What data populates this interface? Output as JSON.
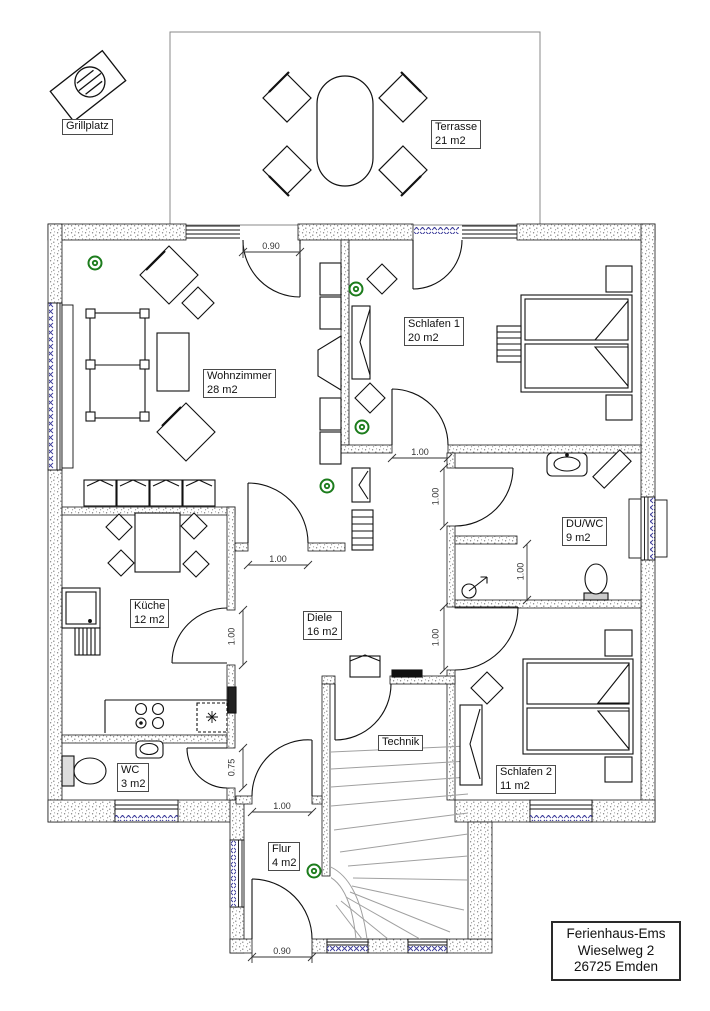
{
  "title_block": {
    "lines": [
      "Ferienhaus-Ems",
      "Wieselweg 2",
      "26725 Emden"
    ]
  },
  "rooms": {
    "grillplatz": {
      "name": "Grillplatz",
      "area": ""
    },
    "terrasse": {
      "name": "Terrasse",
      "area": "21 m2"
    },
    "wohnzimmer": {
      "name": "Wohnzimmer",
      "area": "28 m2"
    },
    "schlafen1": {
      "name": "Schlafen 1",
      "area": "20 m2"
    },
    "duwc": {
      "name": "DU/WC",
      "area": "9 m2"
    },
    "kueche": {
      "name": "Küche",
      "area": "12 m2"
    },
    "diele": {
      "name": "Diele",
      "area": "16 m2"
    },
    "technik": {
      "name": "Technik",
      "area": ""
    },
    "wc": {
      "name": "WC",
      "area": "3 m2"
    },
    "schlafen2": {
      "name": "Schlafen 2",
      "area": "11 m2"
    },
    "flur": {
      "name": "Flur",
      "area": "4 m2"
    }
  },
  "dimensions": {
    "terrace_door": "0.90",
    "schlafen1_door": "1.00",
    "duwc_door": "1.00",
    "shower": "1.00",
    "schlafen2_door": "1.00",
    "wohnzimmer_door": "1.00",
    "kueche_door": "1.00",
    "wc_door": "0.75",
    "flur_door": "1.00",
    "entry_door": "0.90"
  },
  "colors": {
    "smoke_detector": "#1c7c1c",
    "window_marking": "#3a3a99",
    "wall_outline": "#1a1a1a",
    "stair": "#a0a0a0"
  }
}
